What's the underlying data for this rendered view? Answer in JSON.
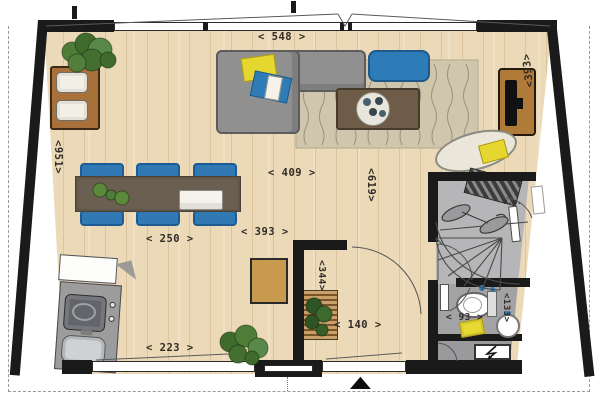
{
  "palette": {
    "floor_wood": "#ecd9b8",
    "wall_black": "#1a1a1a",
    "window_white": "#ffffff",
    "stair_room_gray": "#b6b6b8",
    "bathroom_gray": "#a3a3a6",
    "utility_gray": "#9a9a9d",
    "sofa_gray": "#909090",
    "rug_beige": "#cfc6ad",
    "accent_blue": "#2e7cb7",
    "accent_yellow": "#e6d630",
    "wood_furniture": "#b07a39",
    "dining_table_brown": "#6b5f52",
    "plant_green": "#4e7d38"
  },
  "floorplan": {
    "dimensions": {
      "top_width": "< 548 >",
      "right_depth": "<393>",
      "living_width": "< 409 >",
      "living_depth": "<619>",
      "left_depth": "<951>",
      "kitchen_width": "< 250 >",
      "dining_width": "< 393 >",
      "kitchen_bottom_width": "< 223 >",
      "hall_width": "< 140 >",
      "hall_depth": "<344>",
      "toilet_width": "< 93 >",
      "toilet_depth": "<133>"
    },
    "annotations": {
      "stairwell_note": "v.v."
    },
    "icons": {
      "entrance_arrow": {
        "name": "entrance-arrow",
        "glyph": "▲"
      }
    }
  }
}
